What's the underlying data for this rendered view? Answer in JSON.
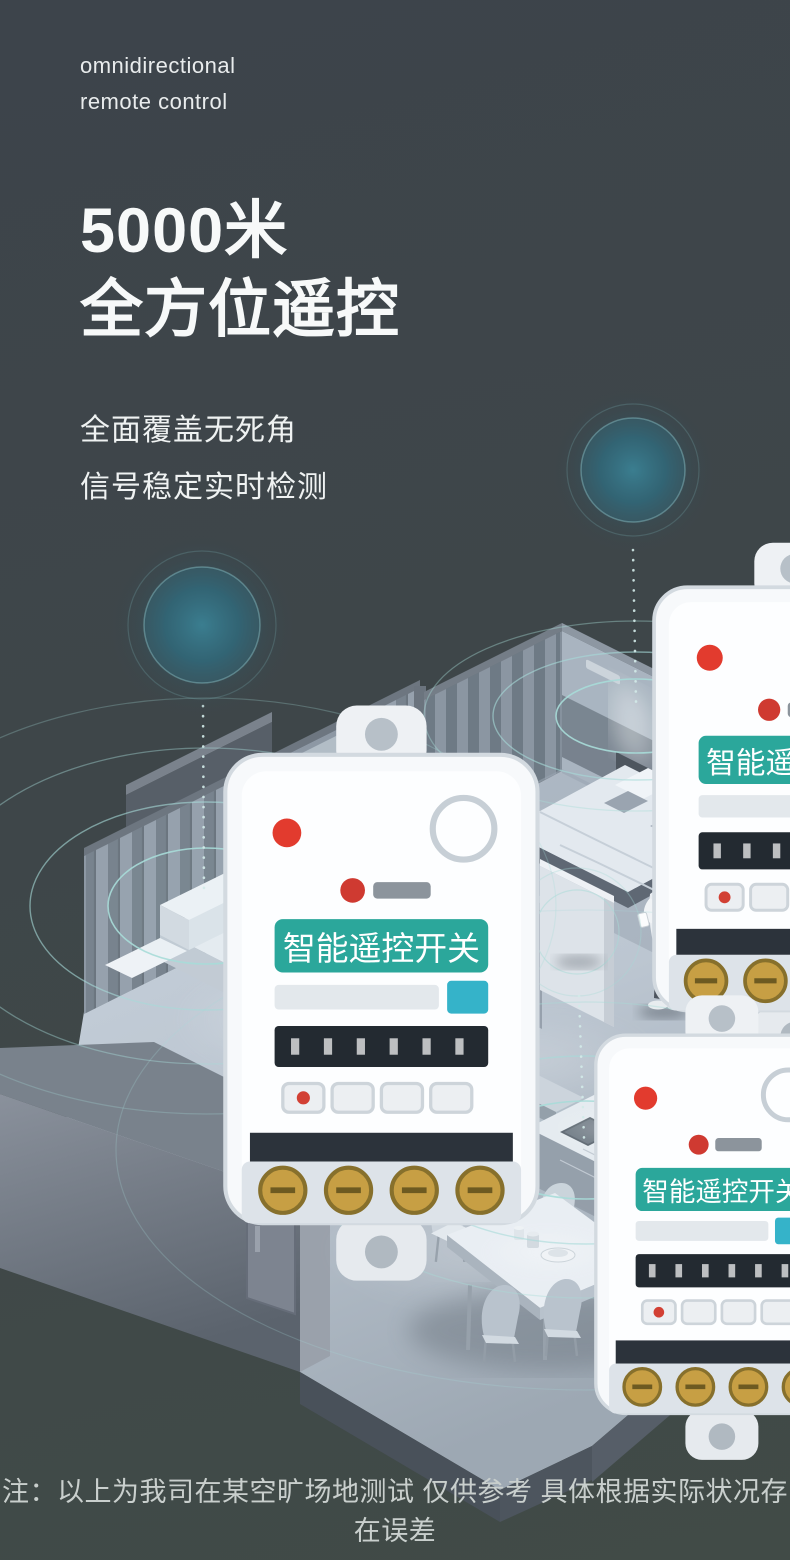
{
  "theme": {
    "background_top": "#3d444b",
    "background_bottom": "#414b47",
    "heading_color": "#f7f9f9",
    "body_text_color": "#eff2f2",
    "footnote_color": "#c9cfcd",
    "ripple_color": "#a7dbd8",
    "device_band_teal": "#2ba79b",
    "device_led_red": "#e23b2e",
    "glow_teal": "#2f6a79"
  },
  "header": {
    "eyebrow": [
      "omnidirectional",
      "remote control"
    ],
    "title_lines": [
      "5000米",
      "全方位遥控"
    ],
    "subtitles": [
      "全面覆盖无死角",
      "信号稳定实时检测"
    ]
  },
  "device": {
    "label": "智能遥控开关"
  },
  "footnote": "注：以上为我司在某空旷场地测试 仅供参考 具体根据实际状况存在误差"
}
